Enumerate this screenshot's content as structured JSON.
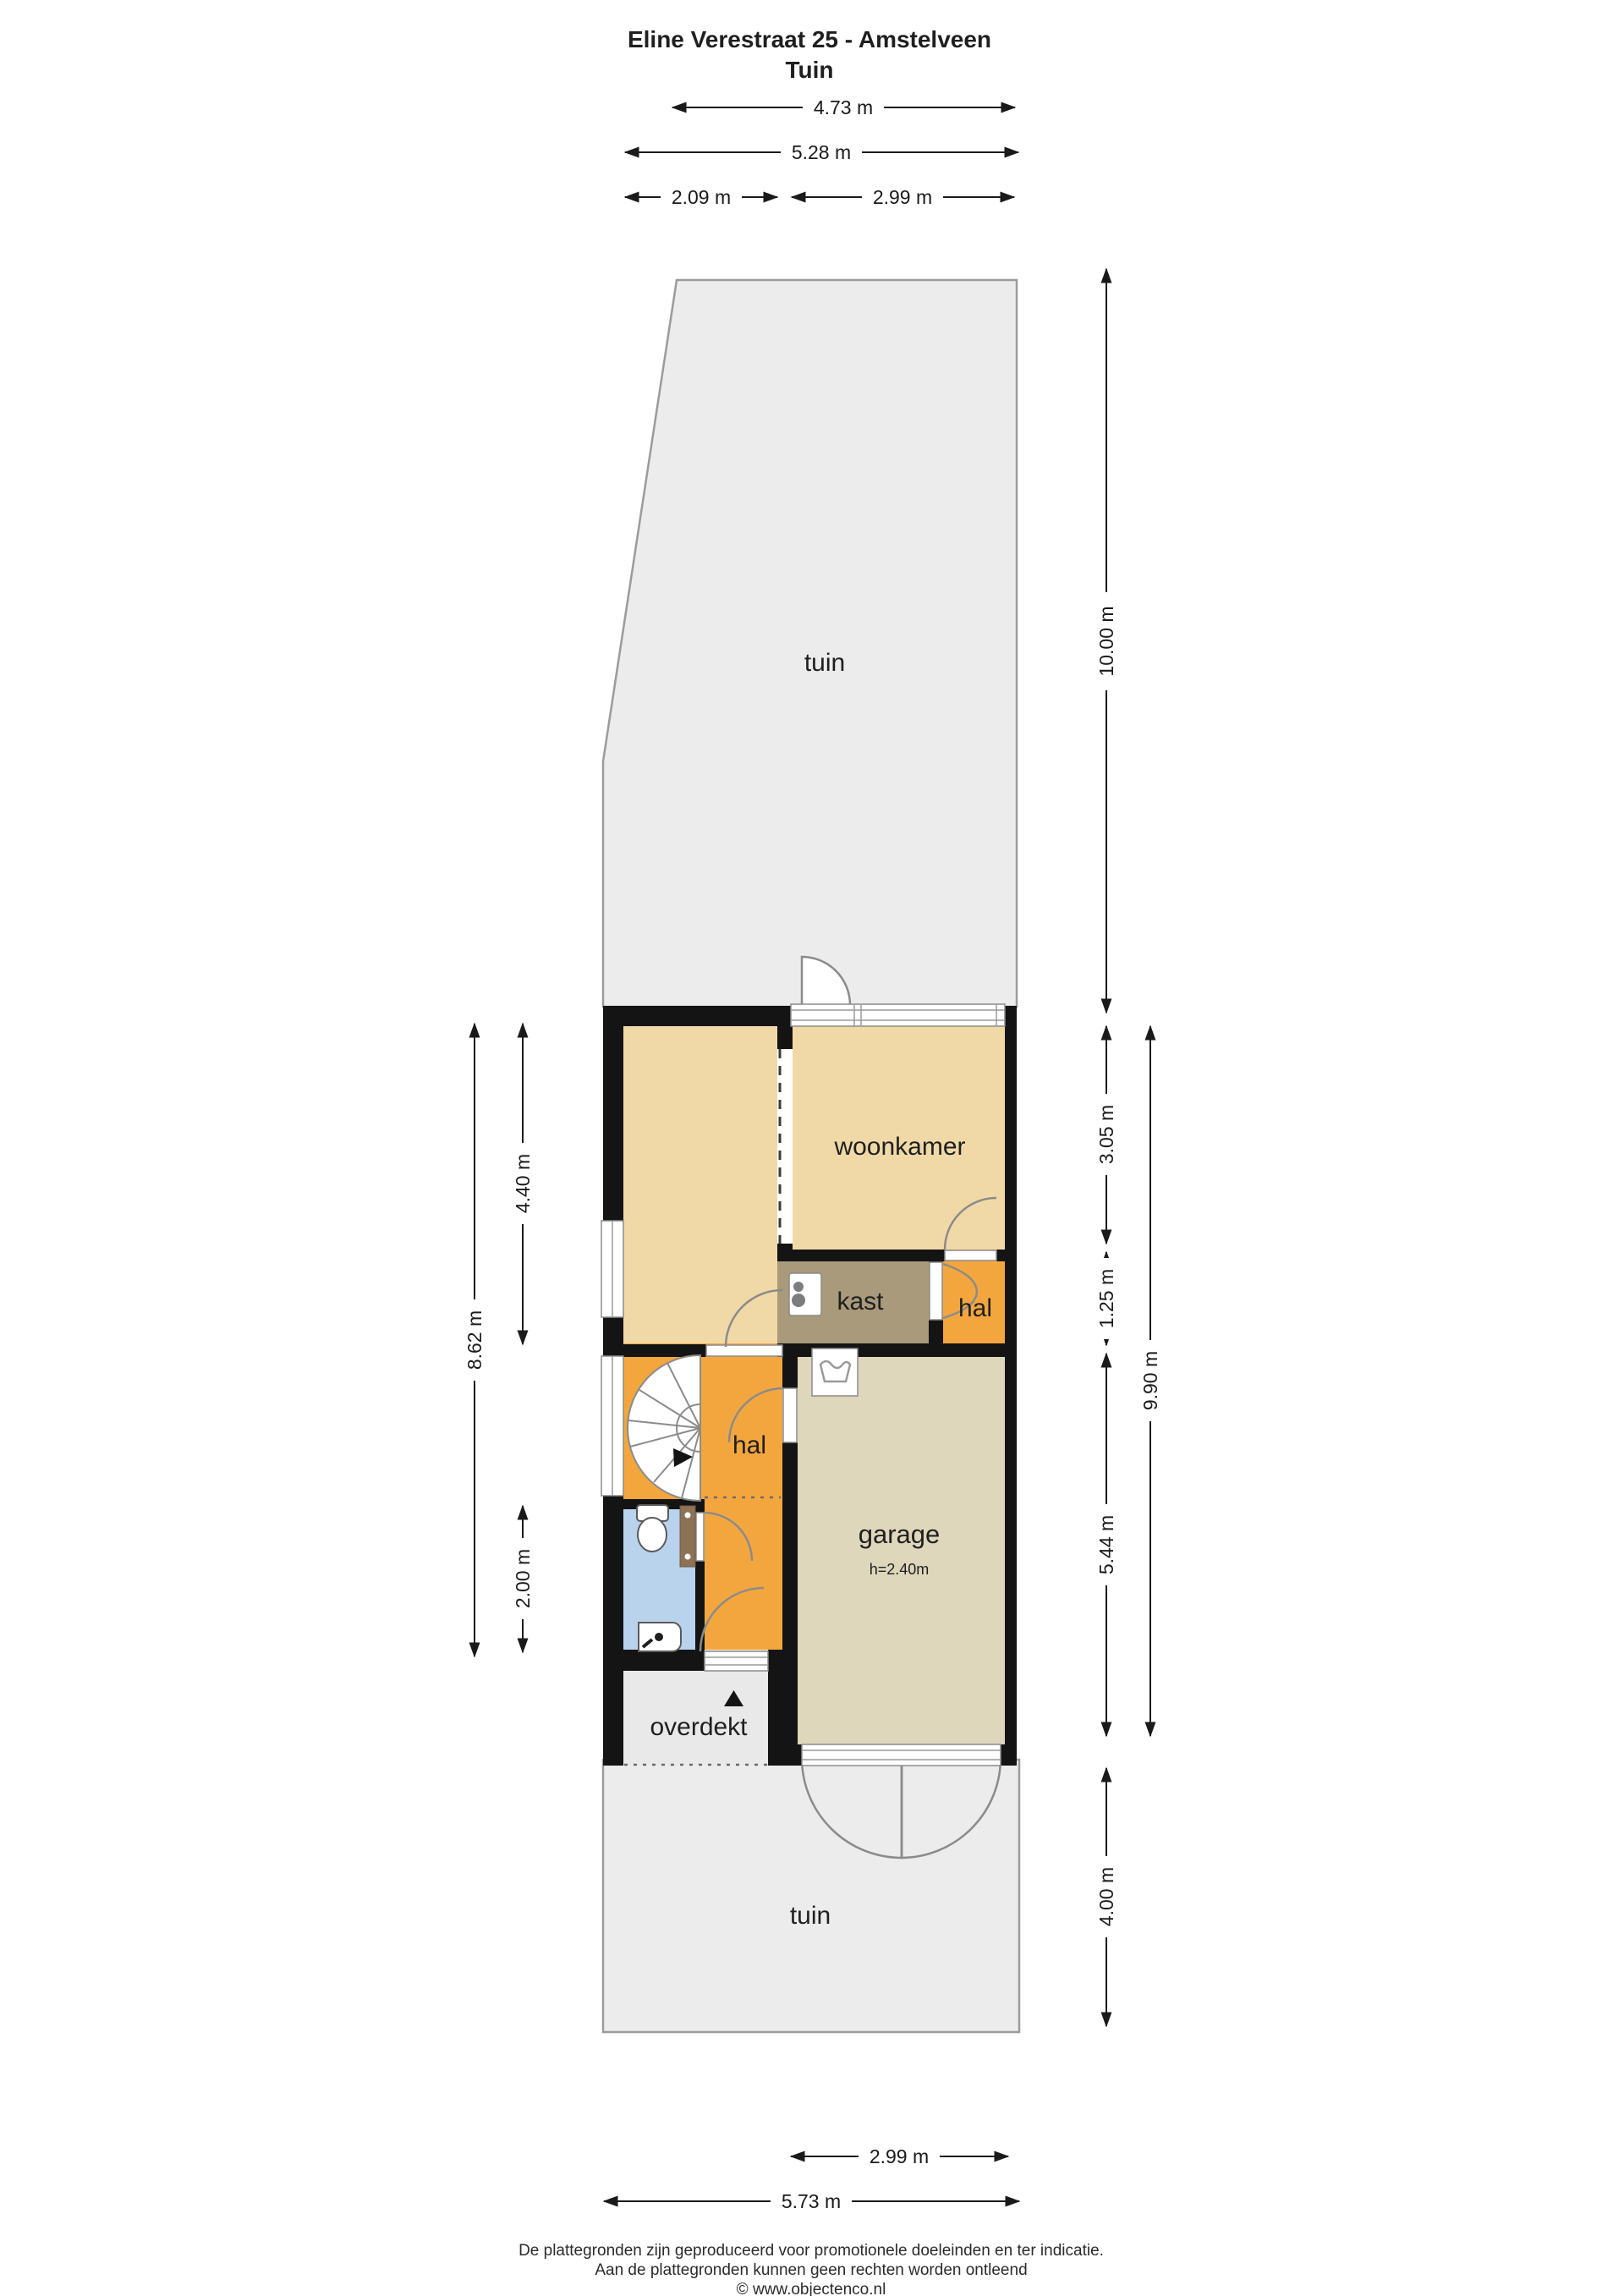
{
  "title": {
    "line1": "Eline Verestraat 25 - Amstelveen",
    "line2": "Tuin"
  },
  "rooms": {
    "tuin_top": "tuin",
    "woonkamer": "woonkamer",
    "kast": "kast",
    "hal_upper": "hal",
    "hal_lower": "hal",
    "garage": "garage",
    "garage_height": "h=2.40m",
    "overdekt": "overdekt",
    "tuin_bottom": "tuin"
  },
  "dimensions": {
    "top": {
      "d473": "4.73 m",
      "d528": "5.28 m",
      "d209": "2.09 m",
      "d299": "2.99 m"
    },
    "right": {
      "d1000": "10.00 m",
      "d305": "3.05 m",
      "d125": "1.25 m",
      "d544": "5.44 m",
      "d990": "9.90 m",
      "d400": "4.00 m"
    },
    "left": {
      "d862": "8.62 m",
      "d440": "4.40 m",
      "d200": "2.00 m"
    },
    "bottom": {
      "d299": "2.99 m",
      "d573": "5.73 m"
    }
  },
  "footer": {
    "line1": "De plattegronden zijn geproduceerd voor promotionele doeleinden en ter indicatie.",
    "line2": "Aan de plattegronden kunnen geen rechten worden ontleend",
    "line3": "© www.objectenco.nl"
  },
  "icons": {
    "stair": "spiral-staircase-icon",
    "washer": "washing-machine-icon",
    "boiler": "boiler-icon",
    "toilet": "toilet-icon",
    "sink": "corner-sink-icon",
    "radiator": "radiator-icon",
    "entrance": "entrance-arrow-icon"
  },
  "colors": {
    "room_tan": "#f1d9a7",
    "room_orange": "#f4a63e",
    "room_kast": "#a89a7a",
    "room_garage": "#ded7bc",
    "room_toilet": "#b9d3ed",
    "garden_gray": "#ececec",
    "overdekt_gray": "#e9e9e9",
    "wall_black": "#141414",
    "radiator_brown": "#8d7356"
  }
}
